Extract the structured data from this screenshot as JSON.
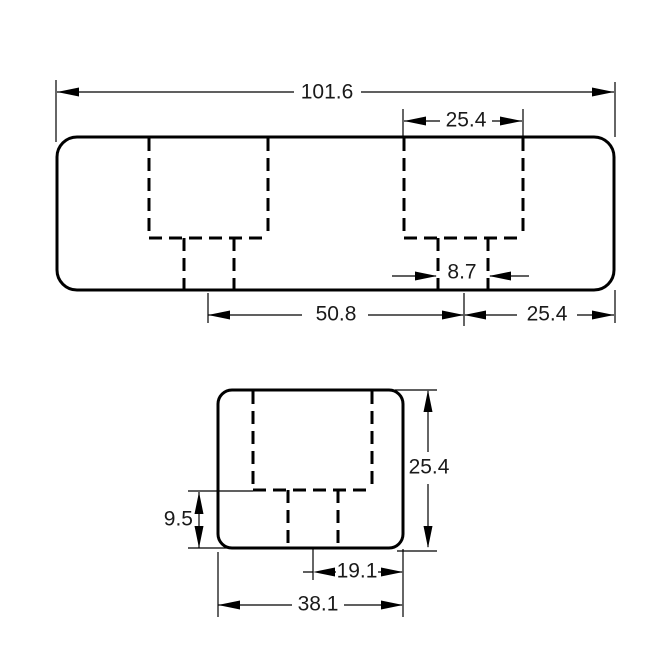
{
  "drawing": {
    "background_color": "#ffffff",
    "line_color": "#000000",
    "text_color": "#1a1a1a",
    "views": {
      "top": {
        "dimensions": {
          "overall_width": "101.6",
          "pocket_width": "25.4",
          "slot_width": "8.7",
          "slot_spacing": "50.8",
          "edge_distance": "25.4"
        }
      },
      "side": {
        "dimensions": {
          "overall_height": "25.4",
          "slot_depth": "9.5",
          "center_to_edge": "19.1",
          "overall_width": "38.1"
        }
      }
    }
  }
}
